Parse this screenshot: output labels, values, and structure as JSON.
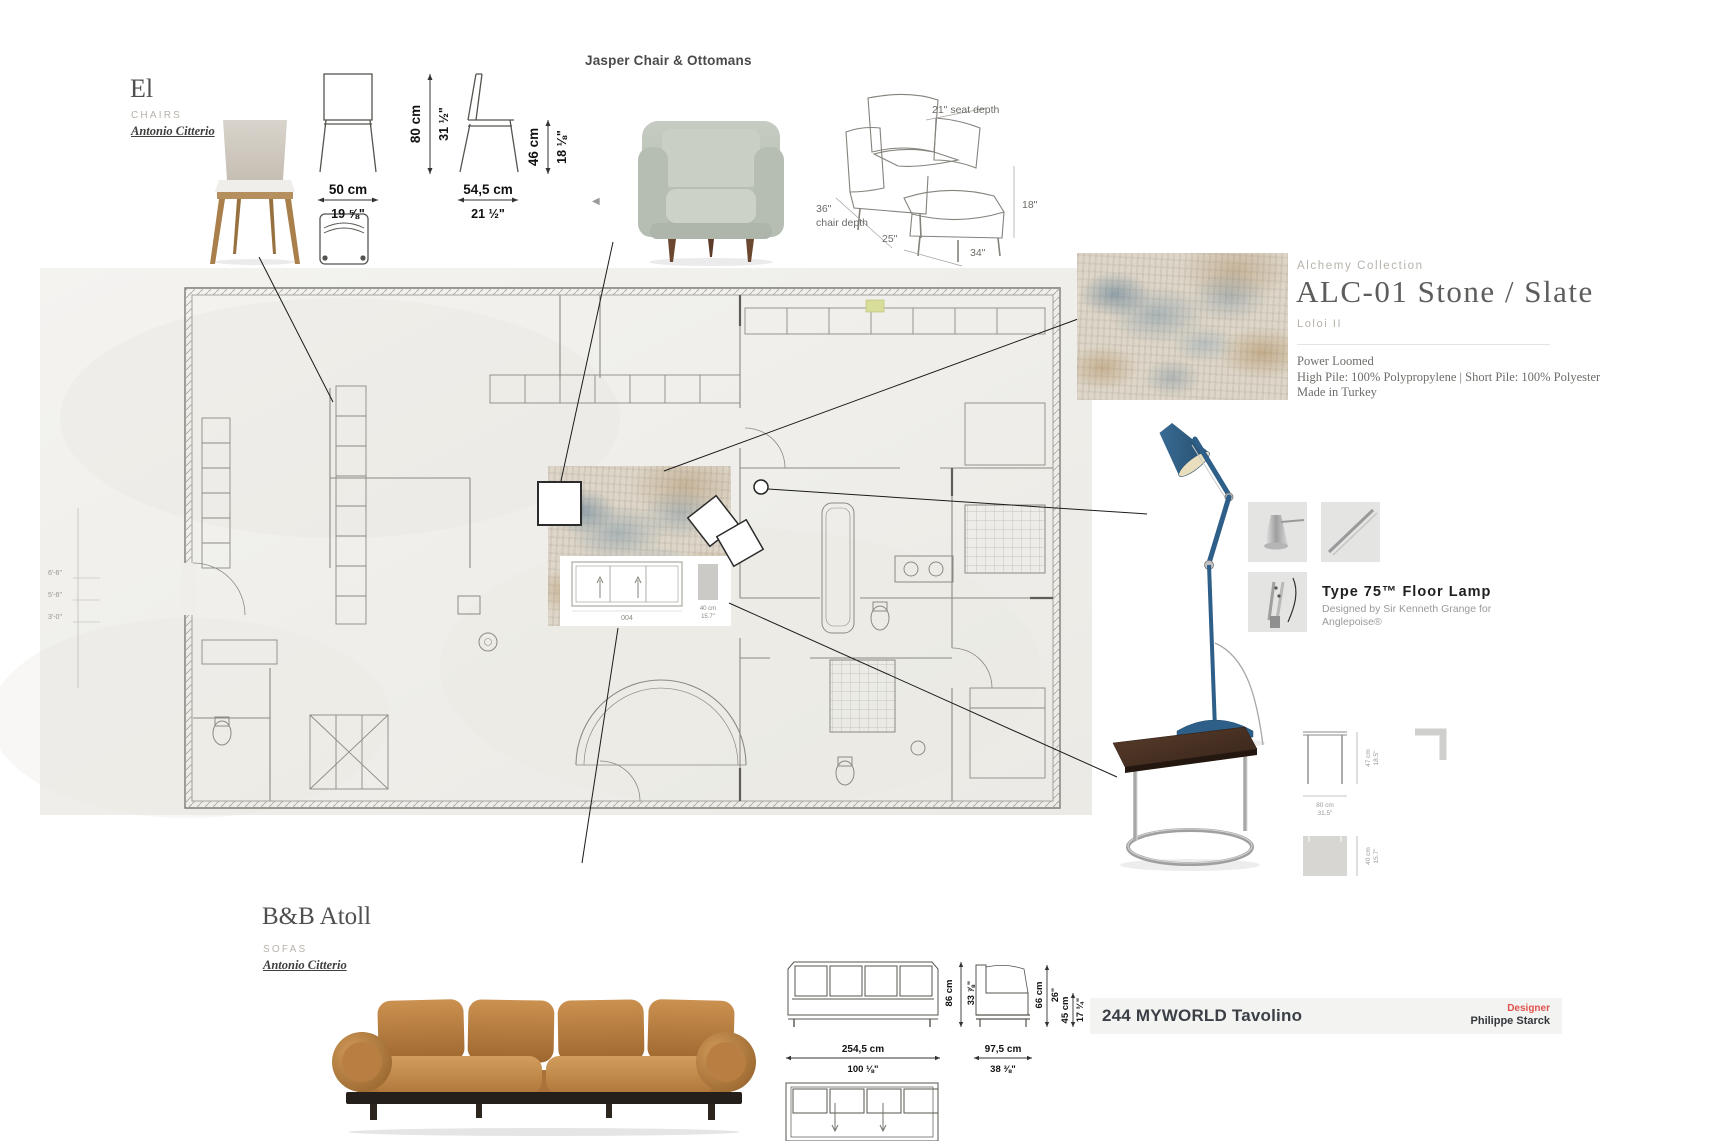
{
  "el": {
    "title": "El",
    "category": "CHAIRS",
    "designer": "Antonio Citterio",
    "dims": {
      "height_cm": "80 cm",
      "height_in": "31 ½\"",
      "seat_height_cm": "46 cm",
      "seat_height_in": "18 ⅛\"",
      "width_cm": "50 cm",
      "width_in": "19 ⅝\"",
      "depth_cm": "54,5 cm",
      "depth_in": "21 ½\""
    }
  },
  "jasper": {
    "title": "Jasper Chair & Ottomans",
    "carousel_prev": "◀",
    "dims": {
      "seat_depth": "21\"  seat depth",
      "chair_depth_value": "36\"",
      "chair_depth_label": "chair depth",
      "ottoman_depth": "25\"",
      "overall_width": "34\"",
      "ottoman_height": "18\""
    }
  },
  "rug": {
    "collection": "Alchemy Collection",
    "name": "ALC-01 Stone / Slate",
    "brand": "Loloi II",
    "construction": "Power Loomed",
    "materials": "High Pile: 100% Polypropylene | Short Pile: 100% Polyester",
    "origin": "Made in Turkey"
  },
  "lamp": {
    "name": "Type 75™ Floor Lamp",
    "byline1": "Designed by Sir Kenneth Grange for",
    "byline2": "Anglepoise®"
  },
  "table": {
    "name": "244 MYWORLD Tavolino",
    "designer_label": "Designer",
    "designer": "Philippe Starck",
    "dims": {
      "height_cm": "47 cm",
      "height_in": "18.5\"",
      "width_cm": "80 cm",
      "width_in": "31.5\"",
      "depth_cm": "40 cm",
      "depth_in": "15.7\""
    }
  },
  "atoll": {
    "title": "B&B Atoll",
    "category": "SOFAS",
    "designer": "Antonio Citterio",
    "dims": {
      "width_cm": "254,5 cm",
      "width_in": "100 ⅛\"",
      "depth_cm": "97,5 cm",
      "depth_in": "38 ⅜\"",
      "height_cm": "86 cm",
      "height_in": "33 ⅞\"",
      "back_height_cm": "66 cm",
      "back_height_in": "26\"",
      "seat_height_cm": "45 cm",
      "seat_height_in": "17 ¾\""
    }
  },
  "plan": {
    "sofa_tag": "004",
    "rug_width_cm": "40 cm",
    "rug_width_in": "15.7\"",
    "margin_dims": [
      "6'-6\"",
      "5'-6\"",
      "3'-0\""
    ]
  }
}
